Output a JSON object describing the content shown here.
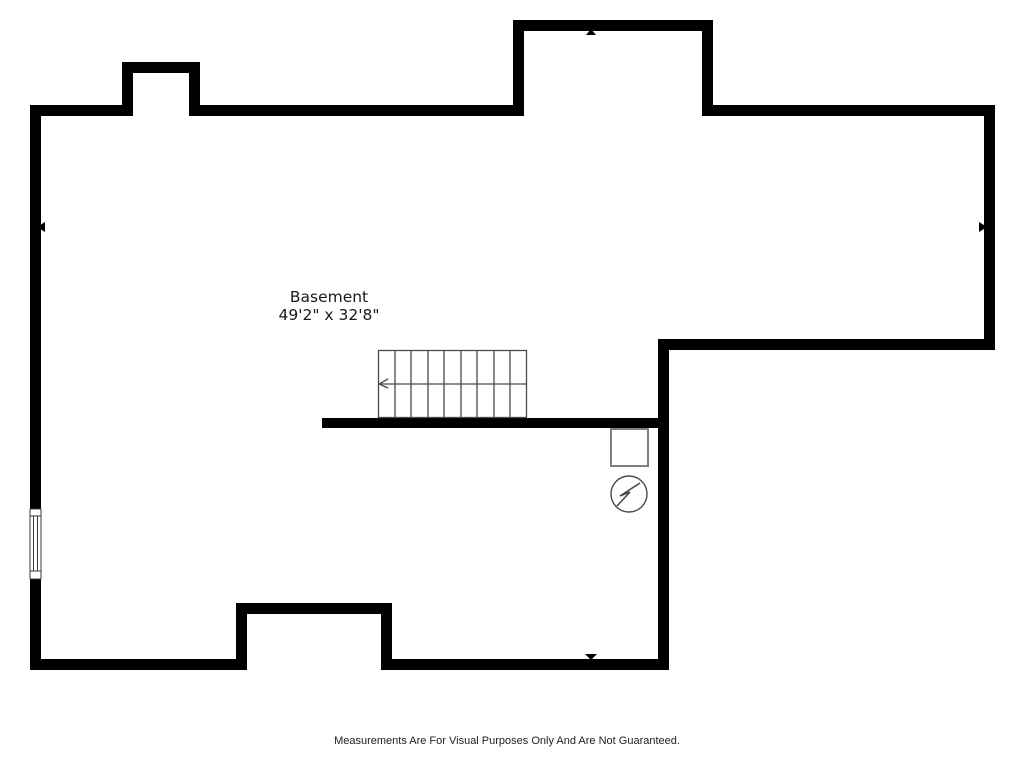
{
  "floor_plan": {
    "room_label": "Basement",
    "room_dimensions": "49'2\" x 32'8\"",
    "disclaimer": "Measurements Are For Visual Purposes Only And Are Not Guaranteed.",
    "colors": {
      "wall": "#000000",
      "stair_outline": "#4a4a4a",
      "fixture_outline": "#808080",
      "background": "#ffffff",
      "label_text": "#1a1a1a"
    },
    "stairs": {
      "treads": 9,
      "arrow_direction": "left"
    },
    "symbols": [
      "staircase",
      "electrical-circle-bolt",
      "furnace-square",
      "window",
      "direction-marker-top",
      "direction-marker-bottom",
      "direction-marker-left",
      "direction-marker-right"
    ]
  }
}
